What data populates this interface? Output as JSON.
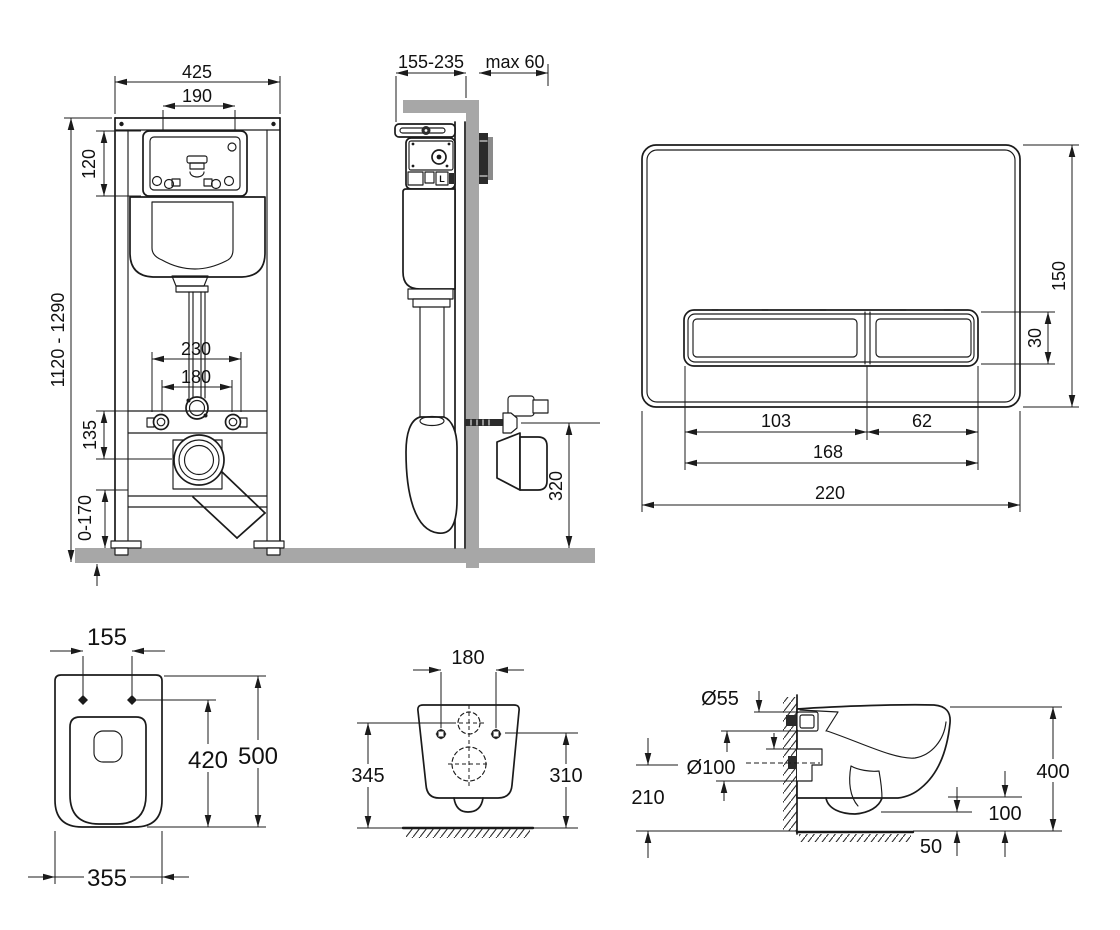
{
  "colors": {
    "line": "#1b1b1b",
    "gray": "#a7a7a7",
    "dark": "#2b2b2b",
    "background": "#ffffff"
  },
  "views": {
    "frame_front": {
      "title": "installation frame front view",
      "dims": {
        "width": "425",
        "window_width": "190",
        "panel_height": "120",
        "height_range": "1120 - 1290",
        "fixing_span_outer": "230",
        "fixing_span_inner": "180",
        "bar_to_outlet": "135",
        "base_adjust": "0-170"
      }
    },
    "frame_side": {
      "title": "installation frame side view",
      "dims": {
        "depth_range": "155-235",
        "wall_max": "max 60",
        "outlet_height": "320"
      },
      "mechanism_mark": "L"
    },
    "flush_plate": {
      "title": "flush plate",
      "dims": {
        "height": "150",
        "button_height": "30",
        "large_button_width": "103",
        "small_button_width": "62",
        "buttons_span": "168",
        "width": "220"
      }
    },
    "bowl_top": {
      "title": "bowl top view",
      "dims": {
        "fixing_spacing": "155",
        "bowl_length": "420",
        "total_length": "500",
        "width": "355"
      }
    },
    "bowl_rear": {
      "title": "bowl rear view",
      "dims": {
        "fixing_spacing": "180",
        "inlet_axis_height": "345",
        "fixing_height": "310"
      }
    },
    "bowl_side": {
      "title": "bowl side view",
      "dims": {
        "inlet_diameter": "Ø55",
        "outlet_diameter": "Ø100",
        "outlet_axis_height": "210",
        "rim_height": "400",
        "underside_clearance": "100",
        "trap_clearance": "50"
      }
    }
  }
}
